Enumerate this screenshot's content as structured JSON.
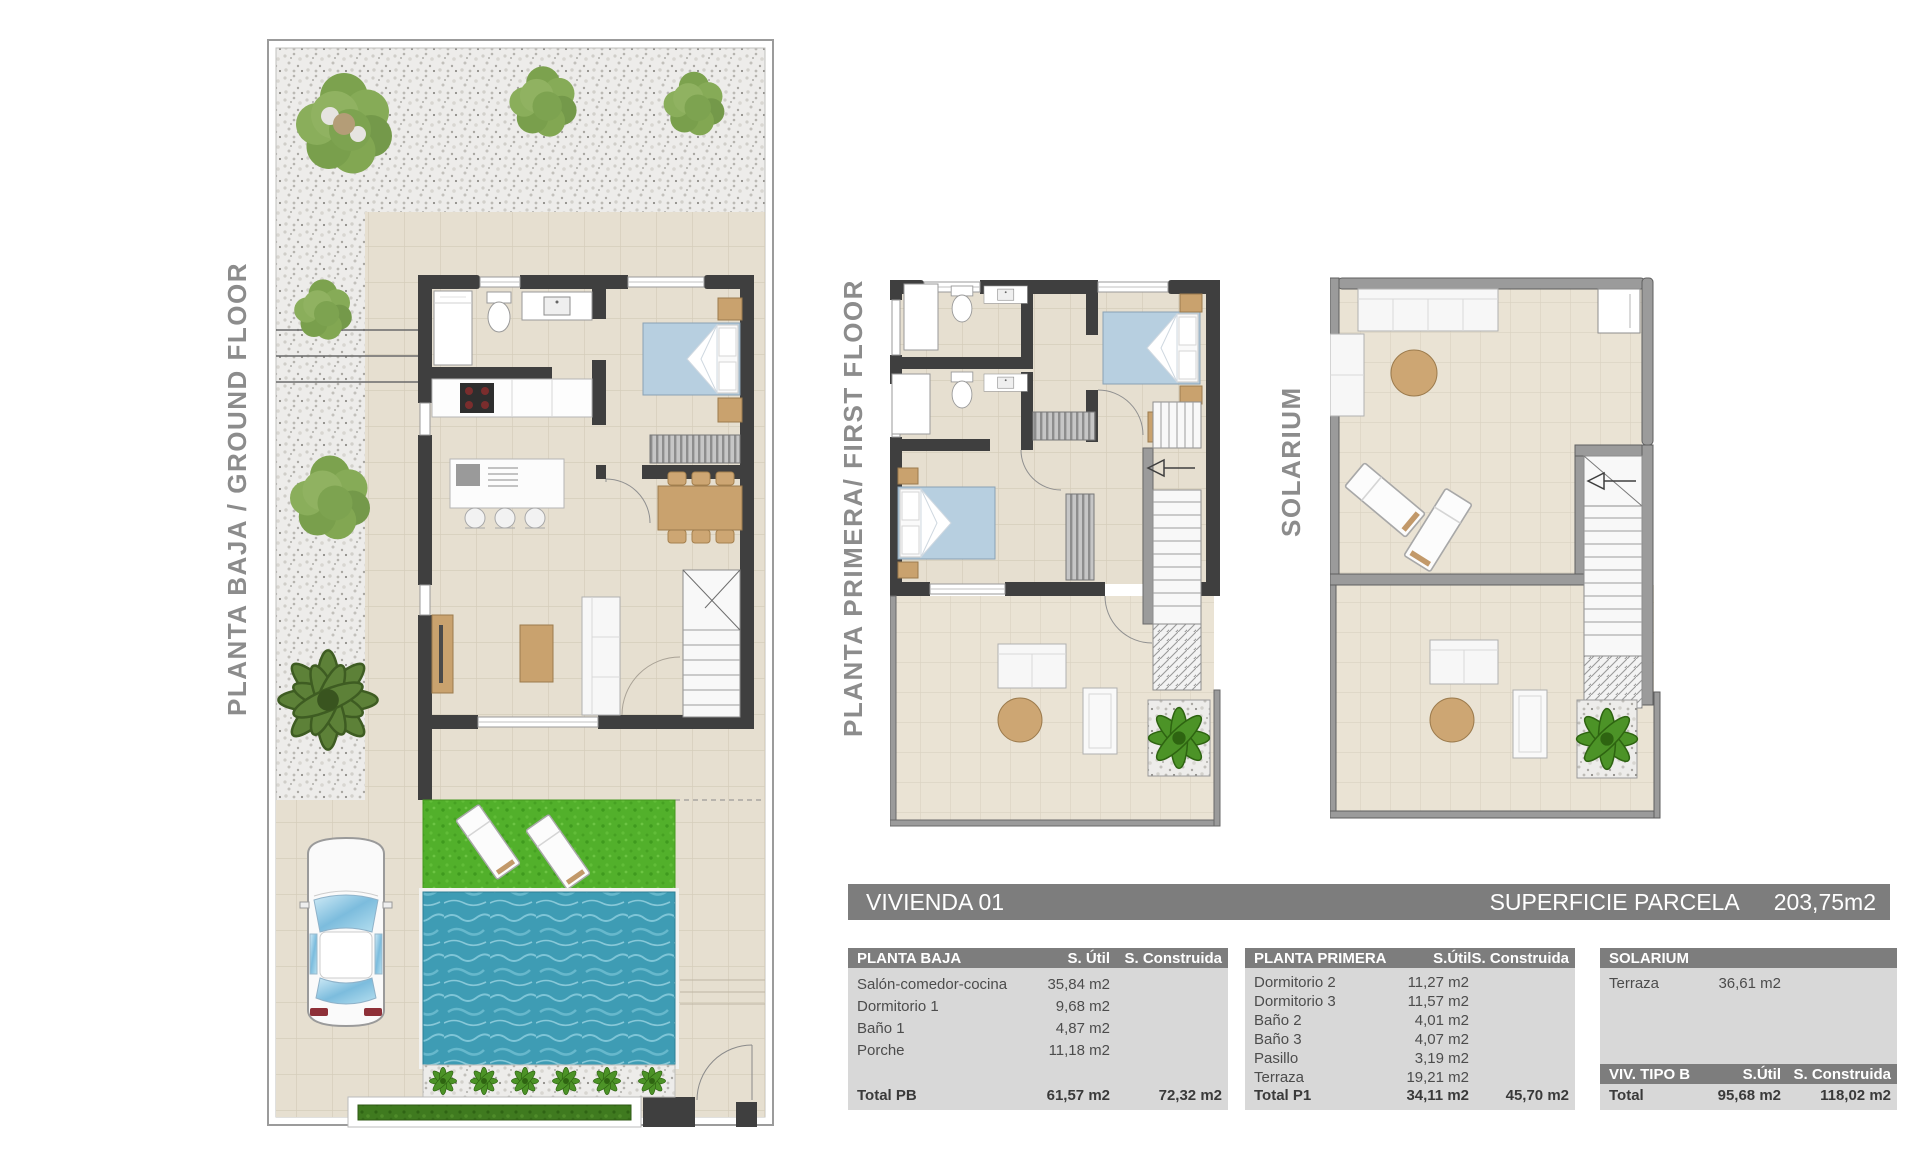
{
  "title_bar": {
    "left": "VIVIENDA 01",
    "right_label": "SUPERFICIE PARCELA",
    "right_value": "203,75m2"
  },
  "plan_labels": {
    "ground": "PLANTA BAJA / GROUND FLOOR",
    "first": "PLANTA PRIMERA/ FIRST FLOOR",
    "solarium": "SOLARIUM"
  },
  "tables": {
    "planta_baja": {
      "title": "PLANTA BAJA",
      "col_util": "S. Útil",
      "col_constr": "S. Construida",
      "rows": [
        {
          "name": "Salón-comedor-cocina",
          "util": "35,84 m2",
          "constr": ""
        },
        {
          "name": "Dormitorio 1",
          "util": "9,68 m2",
          "constr": ""
        },
        {
          "name": "Baño 1",
          "util": "4,87 m2",
          "constr": ""
        },
        {
          "name": "Porche",
          "util": "11,18 m2",
          "constr": ""
        }
      ],
      "total": {
        "name": "Total PB",
        "util": "61,57 m2",
        "constr": "72,32 m2"
      }
    },
    "planta_primera": {
      "title": "PLANTA PRIMERA",
      "col_util": "S.Útil",
      "col_constr": "S. Construida",
      "rows": [
        {
          "name": "Dormitorio 2",
          "util": "11,27 m2",
          "constr": ""
        },
        {
          "name": "Dormitorio 3",
          "util": "11,57 m2",
          "constr": ""
        },
        {
          "name": "Baño 2",
          "util": "4,01 m2",
          "constr": ""
        },
        {
          "name": "Baño 3",
          "util": "4,07 m2",
          "constr": ""
        },
        {
          "name": "Pasillo",
          "util": "3,19 m2",
          "constr": ""
        },
        {
          "name": "Terraza",
          "util": "19,21 m2",
          "constr": ""
        }
      ],
      "total": {
        "name": "Total P1",
        "util": "34,11 m2",
        "constr": "45,70 m2"
      }
    },
    "solarium": {
      "title": "SOLARIUM",
      "rows": [
        {
          "name": "Terraza",
          "util": "36,61 m2",
          "constr": ""
        }
      ],
      "footer": {
        "title": "VIV. TIPO B",
        "col_util": "S.Útil",
        "col_constr": "S. Construida",
        "total": {
          "name": "Total",
          "util": "95,68 m2",
          "constr": "118,02 m2"
        }
      }
    }
  },
  "colors": {
    "header_gray": "#7d7d7d",
    "table_body": "#d8d8d8",
    "label_gray": "#8c8c8c",
    "wall_dark": "#3f3f3f",
    "wall_light": "#9b9b9b",
    "floor_beige": "#e6dfd0",
    "pool_water": "#3e9cb4",
    "lawn_green": "#52b02b",
    "bed_blue": "#b7cfe0",
    "wood_tan": "#c9a26e"
  }
}
